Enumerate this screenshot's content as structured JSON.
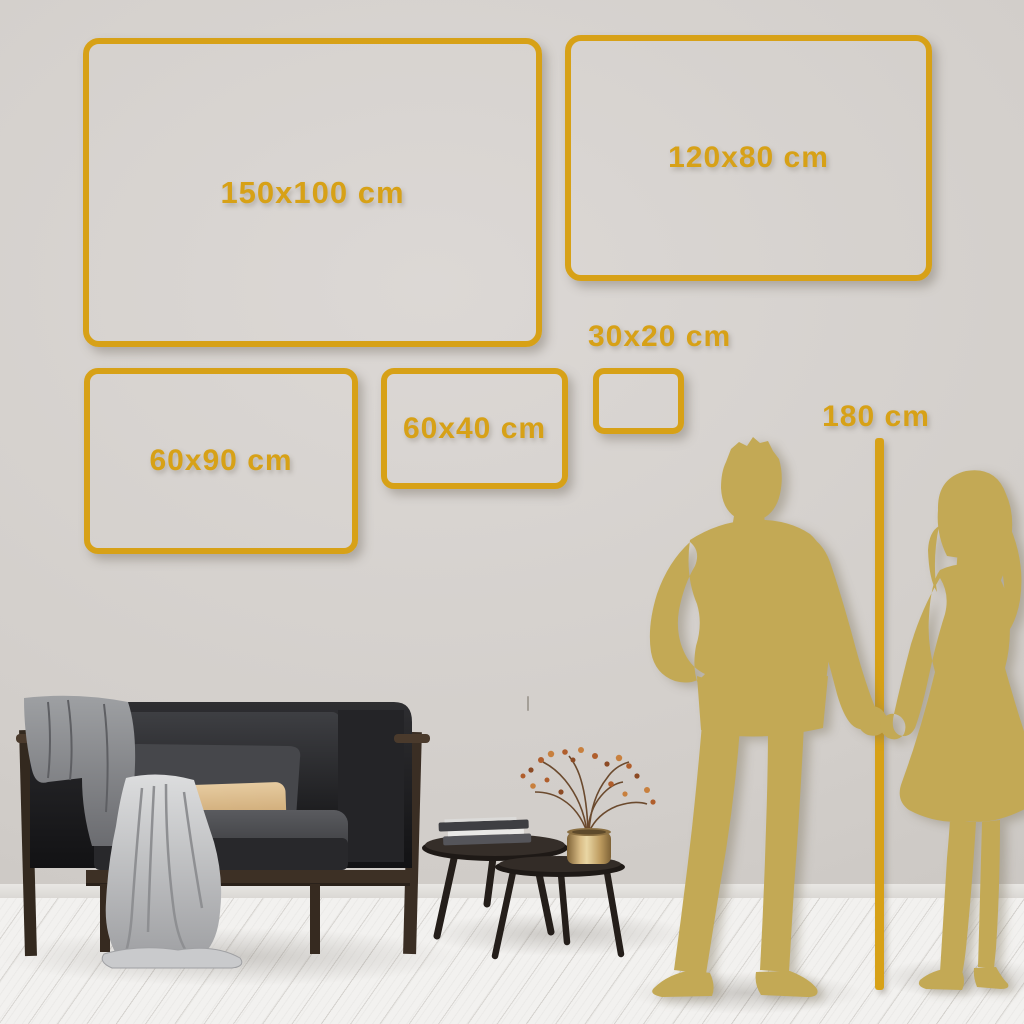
{
  "colors": {
    "accent": "#D7A117",
    "silhouette": "#C3A955",
    "wall": "#D2CECA",
    "wall_light": "#DCD8D5",
    "wall_dark": "#C5C1BD",
    "floor": "#F2F1EF"
  },
  "frames": [
    {
      "label": "150x100 cm"
    },
    {
      "label": "120x80 cm"
    },
    {
      "label": "60x90 cm"
    },
    {
      "label": "60x40 cm"
    },
    {
      "label": "30x20 cm"
    }
  ],
  "height_reference": {
    "label": "180 cm"
  }
}
